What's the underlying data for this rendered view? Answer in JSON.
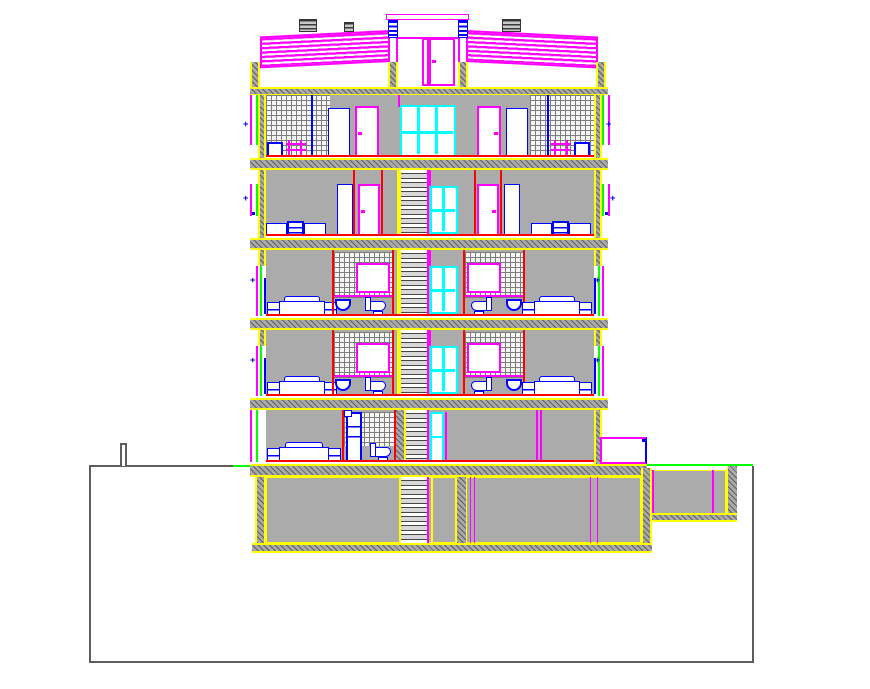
{
  "drawing": {
    "type": "architectural-section-elevation",
    "title": "Multi-storey residential building cross-section CAD drawing",
    "text_labels": [],
    "levels": [
      {
        "id": "roof",
        "label": "roof with dormer and chimneys"
      },
      {
        "id": "attic",
        "label": "attic floor",
        "rooms": [
          "tiled-room-left",
          "hall-doors",
          "stair-window",
          "hall-doors",
          "tiled-room-right"
        ]
      },
      {
        "id": "fourth-floor",
        "label": "fourth floor",
        "rooms": [
          "bedroom-left",
          "wardrobe-hall",
          "staircase",
          "wardrobe-hall",
          "bedroom-right"
        ]
      },
      {
        "id": "third-floor",
        "label": "third floor",
        "rooms": [
          "bedroom-left",
          "bathroom-left",
          "staircase",
          "bathroom-right",
          "bedroom-right"
        ]
      },
      {
        "id": "second-floor",
        "label": "second floor",
        "rooms": [
          "bedroom-left",
          "bathroom-left",
          "staircase",
          "bathroom-right",
          "bedroom-right"
        ]
      },
      {
        "id": "ground-floor",
        "label": "ground floor",
        "rooms": [
          "bedroom",
          "bathroom",
          "staircase",
          "garage-hall"
        ]
      },
      {
        "id": "basement",
        "label": "basement",
        "rooms": [
          "cellar-left",
          "staircase",
          "store",
          "cellar-right",
          "crawl-space-right"
        ]
      }
    ],
    "fixtures": [
      "bed",
      "dresser",
      "wardrobe",
      "toilet",
      "wash-basin",
      "door",
      "window",
      "stair-flight",
      "chimney",
      "planter-box"
    ],
    "site": {
      "ground_line": "stepped ground profile with excavation pit",
      "grade_marks": "green grade lines at building edges"
    }
  },
  "palette": {
    "magenta": "#FF00FF",
    "cyan": "#00FFFF",
    "blue": "#0000FF",
    "red": "#FF0000",
    "yellow": "#FFFF00",
    "green": "#00FF00",
    "grayfill": "#ABABAB",
    "groundgray": "#5E5E5E",
    "white": "#FFFFFF"
  }
}
